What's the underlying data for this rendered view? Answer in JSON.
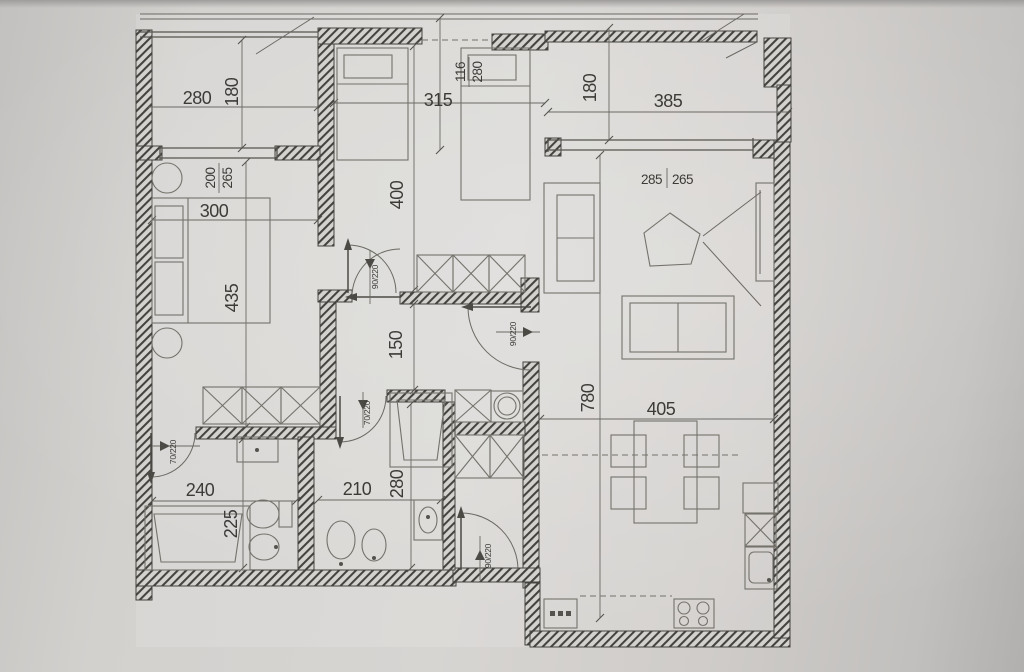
{
  "floorplan": {
    "dims": {
      "balcony_left_width": "280",
      "balcony_left_depth": "180",
      "bedroom_top_width": "315",
      "bedroom_top_depth": "400",
      "balcony_right_width": "385",
      "balcony_right_depth": "180",
      "bedroom_left_width": "300",
      "bedroom_left_depth": "435",
      "hallway_width": "150",
      "living_width": "405",
      "living_depth": "780",
      "bathroom_left_width": "240",
      "bathroom_left_depth": "225",
      "bathroom_mid_width": "210",
      "bathroom_mid_depth": "280"
    },
    "openings": {
      "bedroom_left_window": {
        "w": "200",
        "h": "265"
      },
      "bedroom_top_balcony_door": {
        "w": "116",
        "h": "280"
      },
      "living_window": {
        "w": "285",
        "h": "265"
      },
      "door_bedroom_left": "90/220",
      "door_living": "90/220",
      "door_bathroom_left": "70/220",
      "door_bathroom_mid": "70/220",
      "door_kitchen": "90/220"
    },
    "colors": {
      "paper": "#cfcdca",
      "ink": "#3d3b37",
      "wall_hatch": "#45433f"
    }
  }
}
